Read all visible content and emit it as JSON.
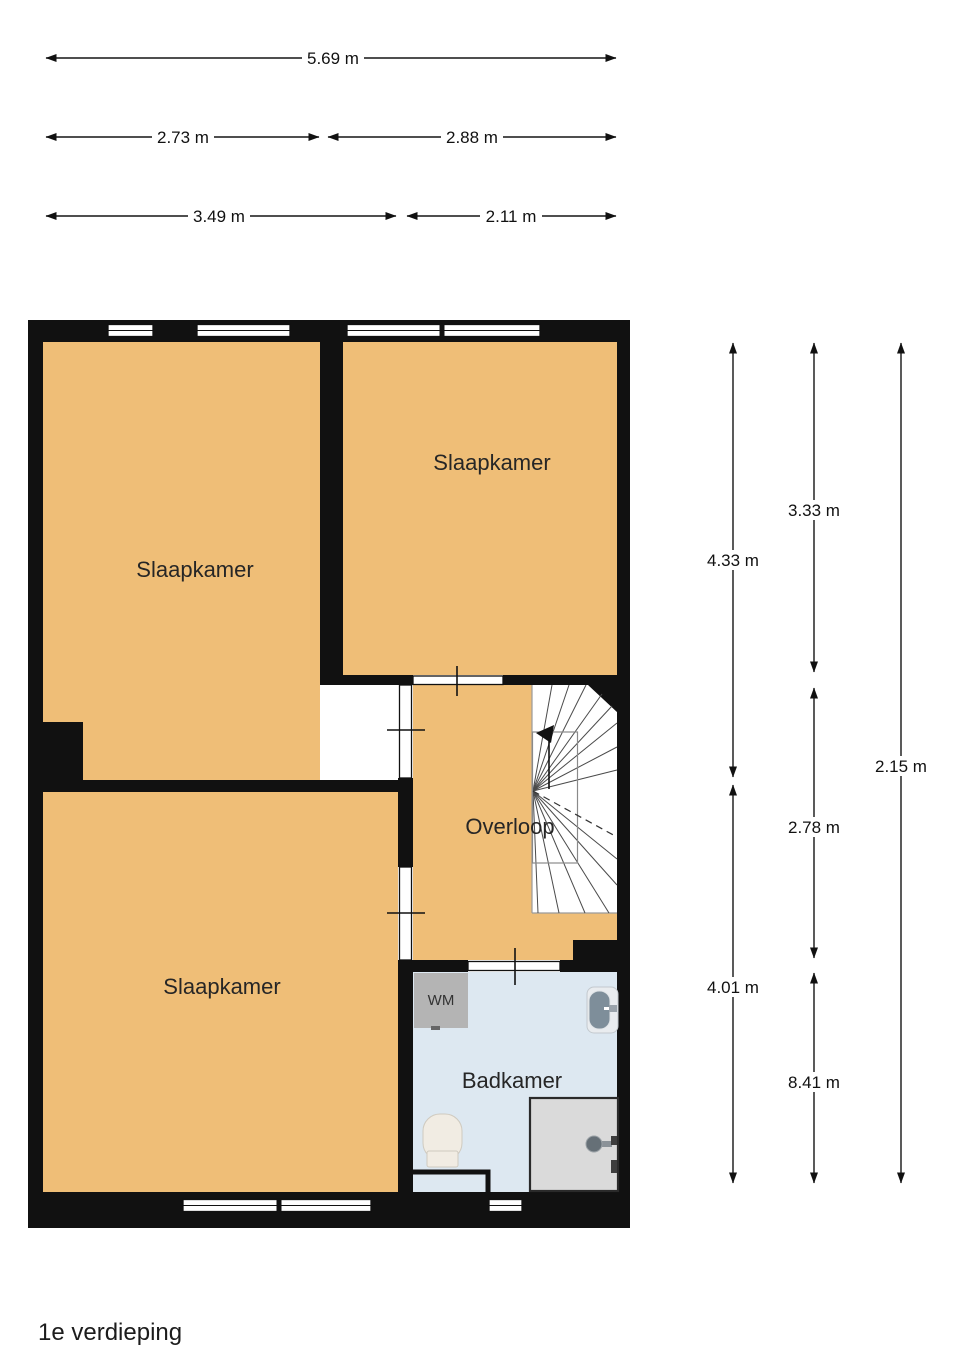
{
  "floor_label": "1e verdieping",
  "colors": {
    "room_fill": "#efbe77",
    "bathroom_fill": "#dde8f1",
    "wall": "#111111",
    "appliance_fill": "#b4b4b4",
    "shower_fill": "#dadada",
    "sink_bowl": "#7e8e9a"
  },
  "dimensions": {
    "top": [
      {
        "label": "5.69 m"
      },
      {
        "label": "2.73 m"
      },
      {
        "label": "2.88 m"
      },
      {
        "label": "3.49 m"
      },
      {
        "label": "2.11 m"
      }
    ],
    "right": [
      {
        "label": "4.33 m"
      },
      {
        "label": "3.33 m"
      },
      {
        "label": "8.41 m"
      },
      {
        "label": "2.78 m"
      },
      {
        "label": "4.01 m"
      },
      {
        "label": "2.15 m"
      }
    ]
  },
  "rooms": {
    "slaapkamer_tl": {
      "label": "Slaapkamer"
    },
    "slaapkamer_tr": {
      "label": "Slaapkamer"
    },
    "slaapkamer_bottom": {
      "label": "Slaapkamer"
    },
    "overloop": {
      "label": "Overloop"
    },
    "badkamer": {
      "label": "Badkamer"
    }
  },
  "fixtures": {
    "washing_machine": {
      "label": "WM"
    }
  }
}
